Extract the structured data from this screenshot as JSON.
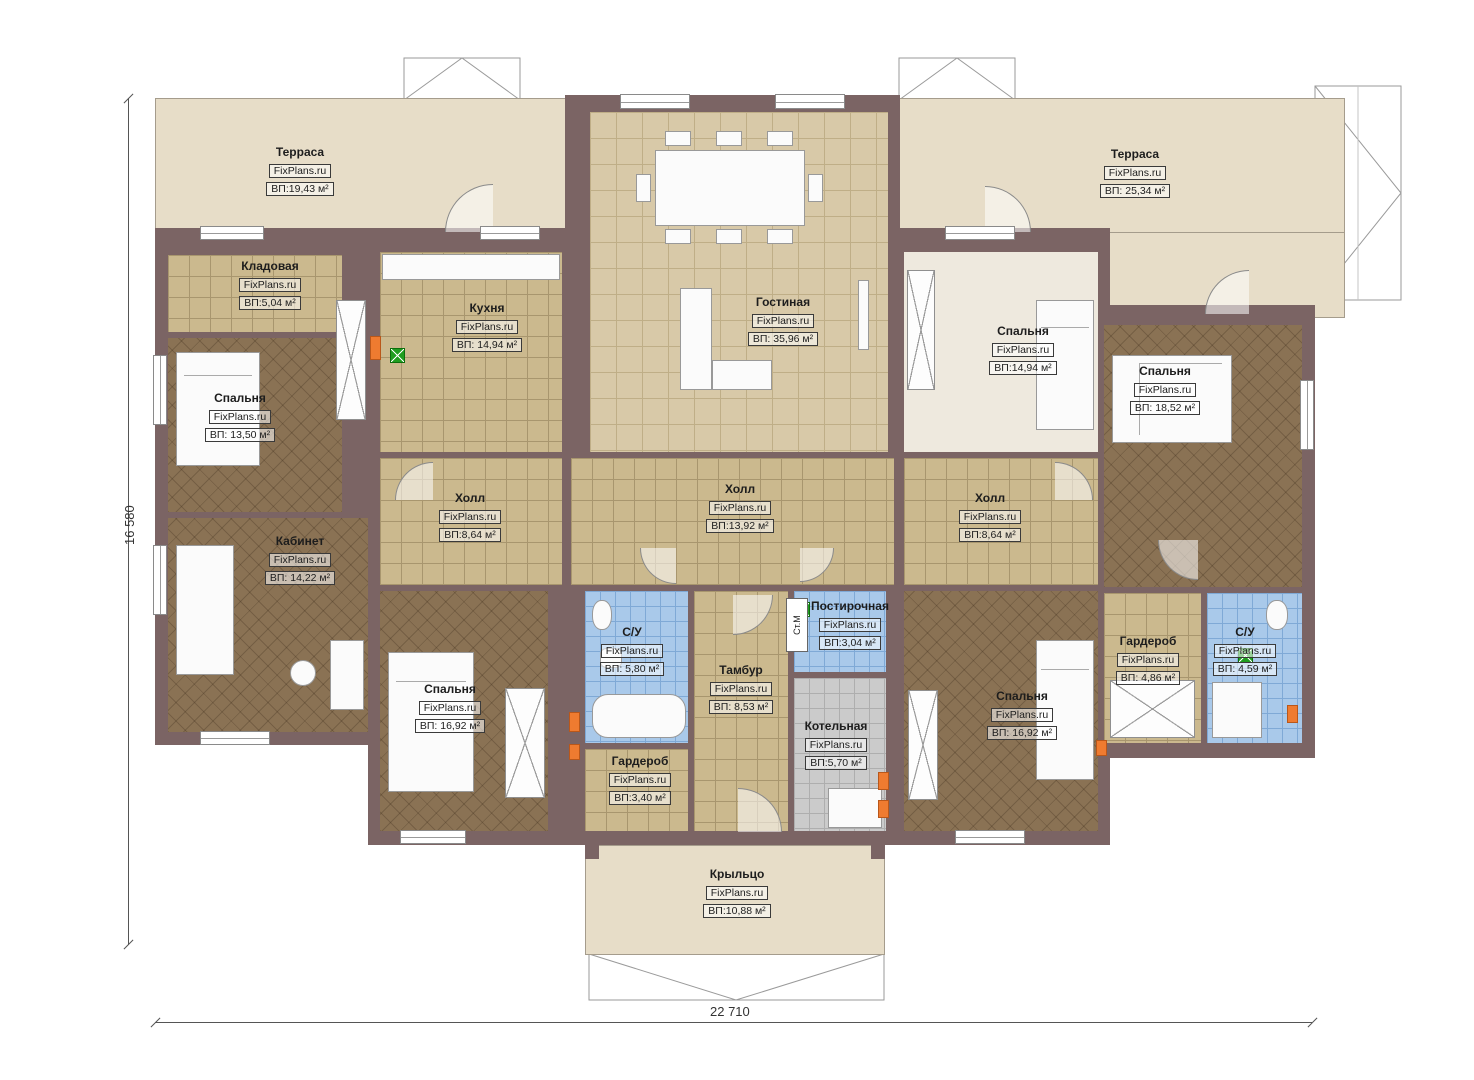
{
  "watermark": "FixPlans.ru",
  "stm_label": "Ст.М",
  "dims": {
    "height": "16 580",
    "width": "22 710"
  },
  "rooms": [
    {
      "name": "Терраса",
      "area": "ВП:19,43 м²"
    },
    {
      "name": "Терраса",
      "area": "ВП: 25,34 м²"
    },
    {
      "name": "Кладовая",
      "area": "ВП:5,04 м²"
    },
    {
      "name": "Кухня",
      "area": "ВП: 14,94 м²"
    },
    {
      "name": "Гостиная",
      "area": "ВП: 35,96 м²"
    },
    {
      "name": "Спальня",
      "area": "ВП:14,94 м²"
    },
    {
      "name": "Спальня",
      "area": "ВП: 18,52 м²"
    },
    {
      "name": "Спальня",
      "area": "ВП: 13,50 м²"
    },
    {
      "name": "Кабинет",
      "area": "ВП: 14,22 м²"
    },
    {
      "name": "Холл",
      "area": "ВП:8,64 м²"
    },
    {
      "name": "Холл",
      "area": "ВП:13,92 м²"
    },
    {
      "name": "Холл",
      "area": "ВП:8,64 м²"
    },
    {
      "name": "С/У",
      "area": "ВП: 5,80 м²"
    },
    {
      "name": "Тамбур",
      "area": "ВП: 8,53 м²"
    },
    {
      "name": "Постирочная",
      "area": "ВП:3,04 м²"
    },
    {
      "name": "Котельная",
      "area": "ВП:5,70 м²"
    },
    {
      "name": "Спальня",
      "area": "ВП: 16,92 м²"
    },
    {
      "name": "Гардероб",
      "area": "ВП:3,40 м²"
    },
    {
      "name": "Гардероб",
      "area": "ВП: 4,86 м²"
    },
    {
      "name": "С/У",
      "area": "ВП: 4,59 м²"
    },
    {
      "name": "Спальня",
      "area": "ВП: 16,92 м²"
    },
    {
      "name": "Крыльцо",
      "area": "ВП:10,88 м²"
    }
  ]
}
